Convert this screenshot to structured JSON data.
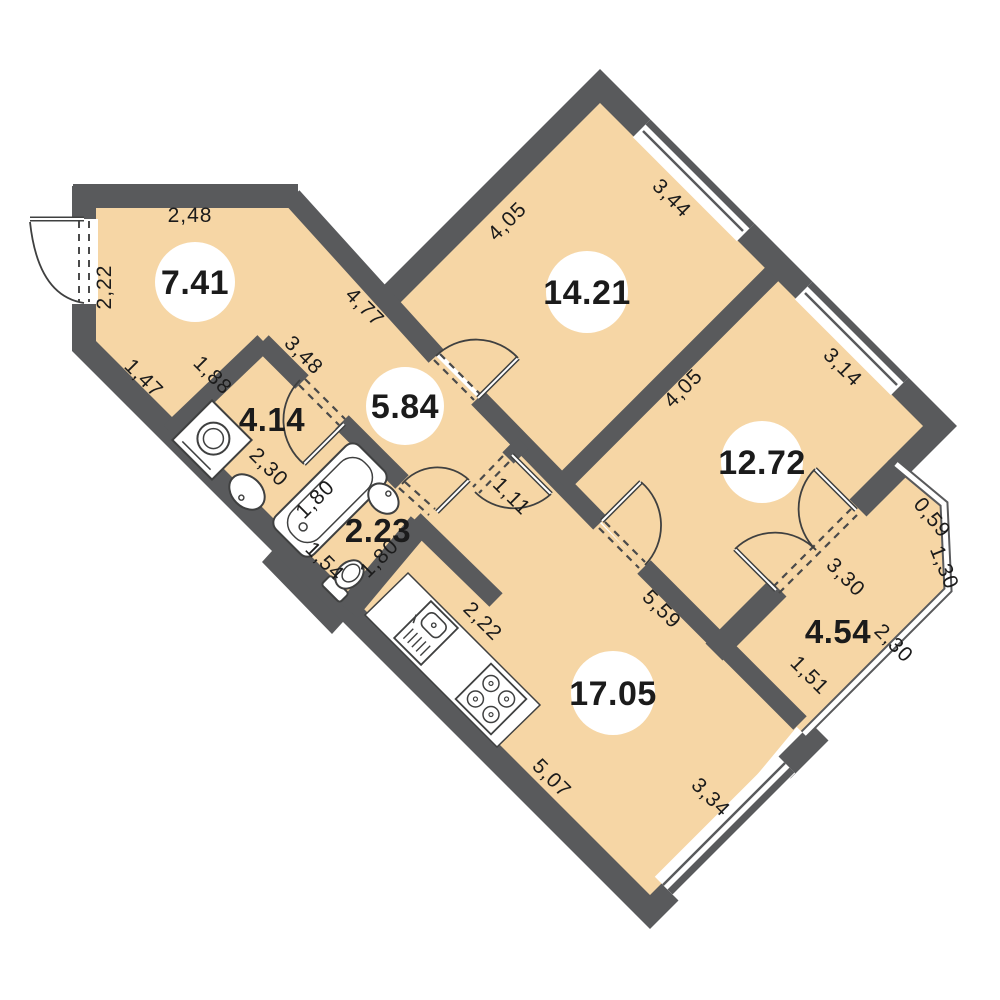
{
  "plan_title": "apartment-floor-plan",
  "units": "meters",
  "colors": {
    "floor": "#F6D6A5",
    "wall": "#595A5C",
    "fixture_line": "#3F4040",
    "text": "#1B1B1B",
    "background": "#FFFFFF",
    "label_bubble": "#FFFFFF"
  },
  "rooms": [
    {
      "name": "entrance-hall",
      "area": "7.41"
    },
    {
      "name": "bedroom-1",
      "area": "14.21"
    },
    {
      "name": "bedroom-2",
      "area": "12.72"
    },
    {
      "name": "hallway",
      "area": "5.84"
    },
    {
      "name": "bathroom",
      "area": "4.14"
    },
    {
      "name": "wc",
      "area": "2.23"
    },
    {
      "name": "kitchen-living-room",
      "area": "17.05"
    },
    {
      "name": "balcony",
      "area": "4.54"
    }
  ],
  "dimensions": [
    {
      "label": "2,48",
      "of": "entrance-hall-top-wall"
    },
    {
      "label": "2,22",
      "of": "entrance-hall-left-wall"
    },
    {
      "label": "1,47",
      "of": "entrance-hall-sw-wall-segment-1"
    },
    {
      "label": "1,88",
      "of": "entrance-hall-sw-wall-segment-2"
    },
    {
      "label": "4,77",
      "of": "entrance-hall-ne-wall"
    },
    {
      "label": "3,48",
      "of": "bathroom-ne-wall"
    },
    {
      "label": "4,05",
      "of": "bedroom-1-nw-wall"
    },
    {
      "label": "3,44",
      "of": "bedroom-1-window-wall"
    },
    {
      "label": "4,05",
      "of": "bedroom-2-nw-wall"
    },
    {
      "label": "3,14",
      "of": "bedroom-2-window-wall"
    },
    {
      "label": "0,59",
      "of": "balcony-bay-edge-1"
    },
    {
      "label": "1,30",
      "of": "balcony-bay-edge-2"
    },
    {
      "label": "3,30",
      "of": "balcony-door-wall"
    },
    {
      "label": "2,30",
      "of": "balcony-bay-edge-3"
    },
    {
      "label": "1,51",
      "of": "balcony-sw-wall"
    },
    {
      "label": "5,59",
      "of": "kitchen-living-ne-wall"
    },
    {
      "label": "1,11",
      "of": "corridor-opening"
    },
    {
      "label": "2,30",
      "of": "bathroom-sw-wall"
    },
    {
      "label": "1,80",
      "of": "bathtub"
    },
    {
      "label": "1,54",
      "of": "wc-sw-wall"
    },
    {
      "label": "1,80",
      "of": "wc-se-wall"
    },
    {
      "label": "2,22",
      "of": "kitchen-counter"
    },
    {
      "label": "5,07",
      "of": "kitchen-living-sw-wall"
    },
    {
      "label": "3,34",
      "of": "kitchen-living-window-wall"
    }
  ],
  "fixtures": [
    "washing-machine",
    "pedestal-sink",
    "bathtub",
    "wc-sink",
    "toilet",
    "kitchen-counter",
    "kitchen-sink",
    "stove"
  ],
  "doors": [
    "entrance-door",
    "bedroom-1-door",
    "bathroom-door",
    "wc-door",
    "bedroom-2-door",
    "kitchen-living-door",
    "balcony-french-doors"
  ],
  "windows": [
    "bedroom-1-window",
    "bedroom-2-window",
    "kitchen-living-window",
    "balcony-glazing"
  ]
}
